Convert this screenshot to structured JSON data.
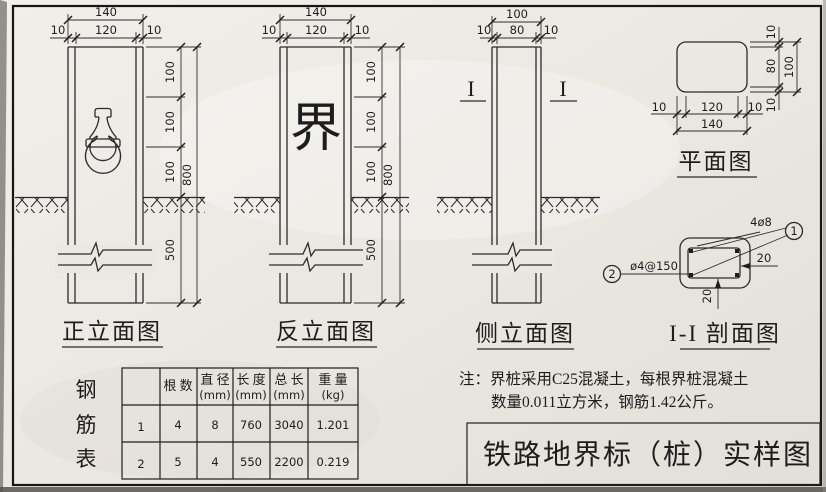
{
  "drawing": {
    "views": {
      "front": {
        "label": "正立面图"
      },
      "rear": {
        "label": "反立面图",
        "face_text": "界"
      },
      "side": {
        "label": "侧立面图",
        "section_mark": "I"
      },
      "plan": {
        "label": "平面图"
      },
      "section": {
        "label": "I-I 剖面图"
      }
    },
    "dims": {
      "d10": "10",
      "d20": "20",
      "d80": "80",
      "d100": "100",
      "d120": "120",
      "d140": "140",
      "d500": "500",
      "d800": "800"
    },
    "callouts": {
      "main_bars": "4ø8",
      "stirrup": "ø4@150",
      "bubble1": "1",
      "bubble2": "2"
    },
    "ink_color": "#2b2b2b",
    "paper_color": "#ebe8e2"
  },
  "rebar_table": {
    "vertical_title": [
      "钢",
      "筋",
      "表"
    ],
    "headers": [
      {
        "name": "根 数",
        "unit": ""
      },
      {
        "name": "直 径",
        "unit": "(mm)"
      },
      {
        "name": "长 度",
        "unit": "(mm)"
      },
      {
        "name": "总 长",
        "unit": "(mm)"
      },
      {
        "name": "重 量",
        "unit": "(kg)"
      }
    ],
    "rows": [
      {
        "no": "1",
        "count": "4",
        "dia": "8",
        "len": "760",
        "total": "3040",
        "weight": "1.201"
      },
      {
        "no": "2",
        "count": "5",
        "dia": "4",
        "len": "550",
        "total": "2200",
        "weight": "0.219"
      }
    ]
  },
  "notes": {
    "line1": "注：界桩采用C25混凝土，每根界桩混凝土",
    "line2": "数量0.011立方米，钢筋1.42公斤。"
  },
  "title_block": {
    "title": "铁路地界标（桩）实样图"
  }
}
